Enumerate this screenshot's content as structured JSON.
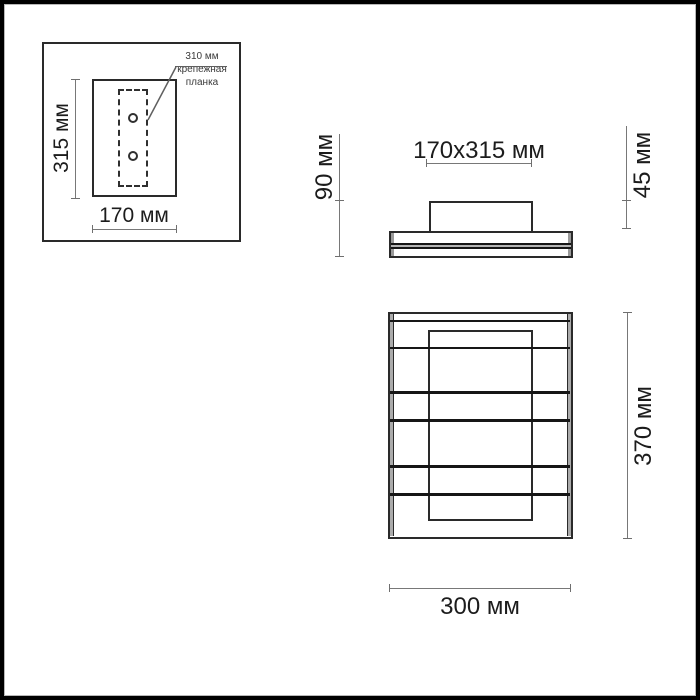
{
  "diagram": {
    "inset": {
      "height_label": "315 мм",
      "width_label": "170 мм",
      "callout_line1": "310 мм",
      "callout_line2": "крепежная",
      "callout_line3": "планка"
    },
    "side_view": {
      "total_height_label": "90 мм",
      "plate_size_label": "170x315 мм",
      "box_height_label": "45 мм"
    },
    "front_view": {
      "height_label": "370 мм",
      "width_label": "300 мм"
    },
    "colors": {
      "background": "#ffffff",
      "outline": "#2a2a2a",
      "dimension_line": "#787878",
      "frame_border": "#000000",
      "cap_gray": "#9a9a9a"
    }
  }
}
